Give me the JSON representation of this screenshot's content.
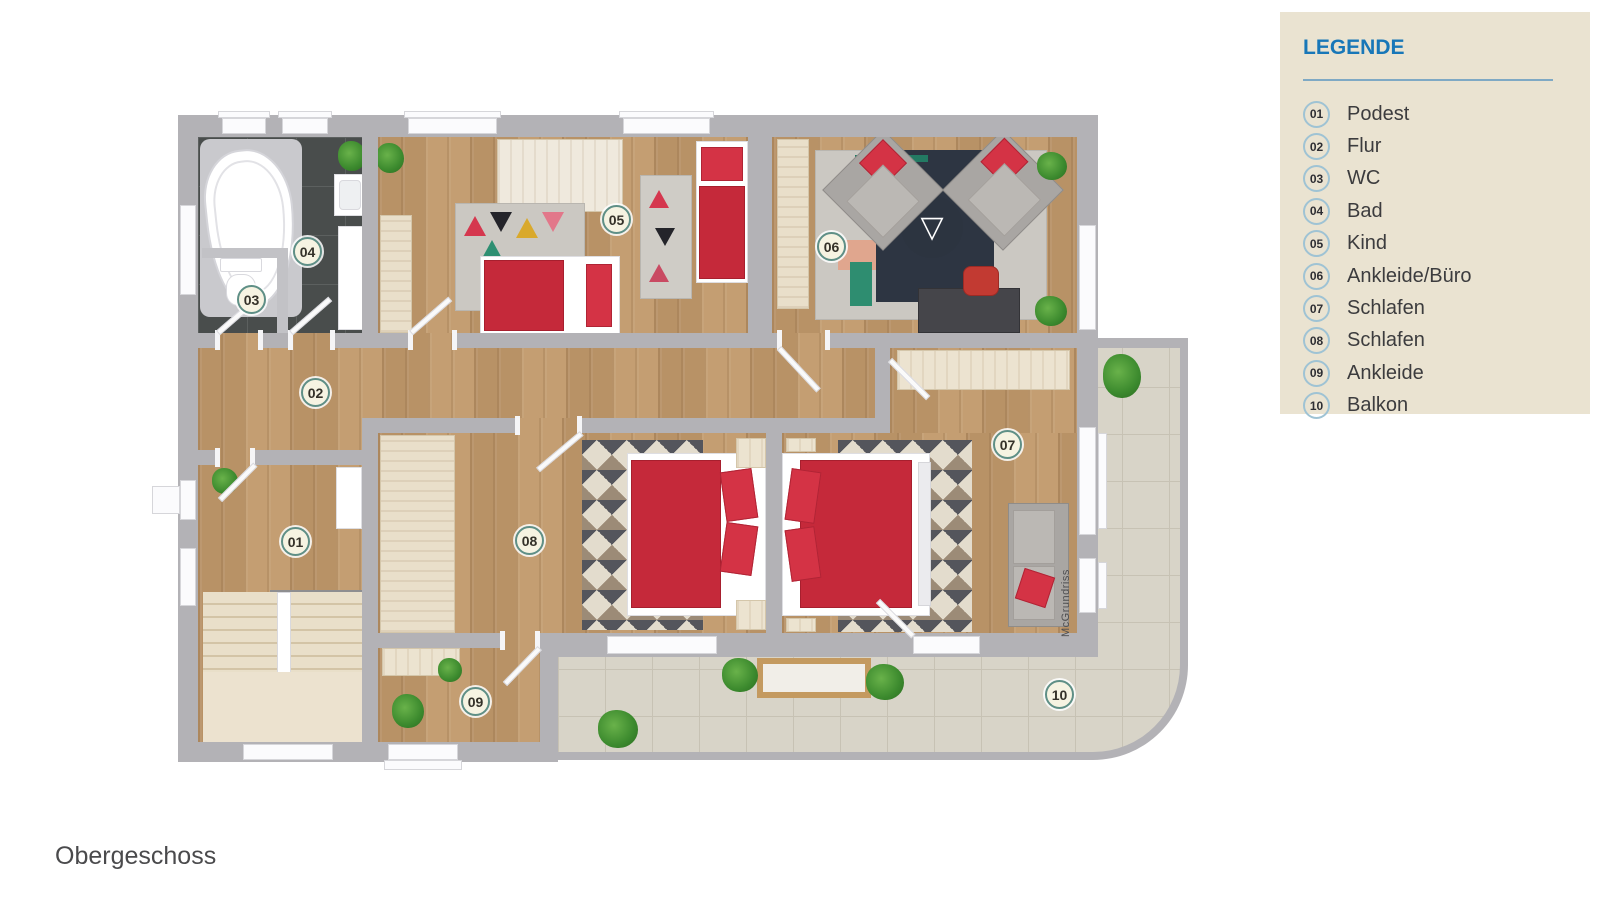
{
  "legend": {
    "title": "LEGENDE",
    "items": [
      {
        "num": "01",
        "label": "Podest"
      },
      {
        "num": "02",
        "label": "Flur"
      },
      {
        "num": "03",
        "label": "WC"
      },
      {
        "num": "04",
        "label": "Bad"
      },
      {
        "num": "05",
        "label": "Kind"
      },
      {
        "num": "06",
        "label": "Ankleide/Büro"
      },
      {
        "num": "07",
        "label": "Schlafen"
      },
      {
        "num": "08",
        "label": "Schlafen"
      },
      {
        "num": "09",
        "label": "Ankleide"
      },
      {
        "num": "10",
        "label": "Balkon"
      }
    ]
  },
  "plan": {
    "floor_label": "Obergeschoss",
    "watermark": "McGrundriss"
  },
  "icons": {
    "compass_triangle": "▽"
  },
  "colors": {
    "accent_blue": "#1877b8",
    "legend_panel_bg": "#eae3d1",
    "wall_gray": "#b3b2b6",
    "wood_floor": "#c29a6c",
    "bath_tile": "#494d4c",
    "balcony_tile": "#d8d4c8",
    "bed_red": "#c5293a",
    "stairs_cream": "#e9dfca"
  }
}
